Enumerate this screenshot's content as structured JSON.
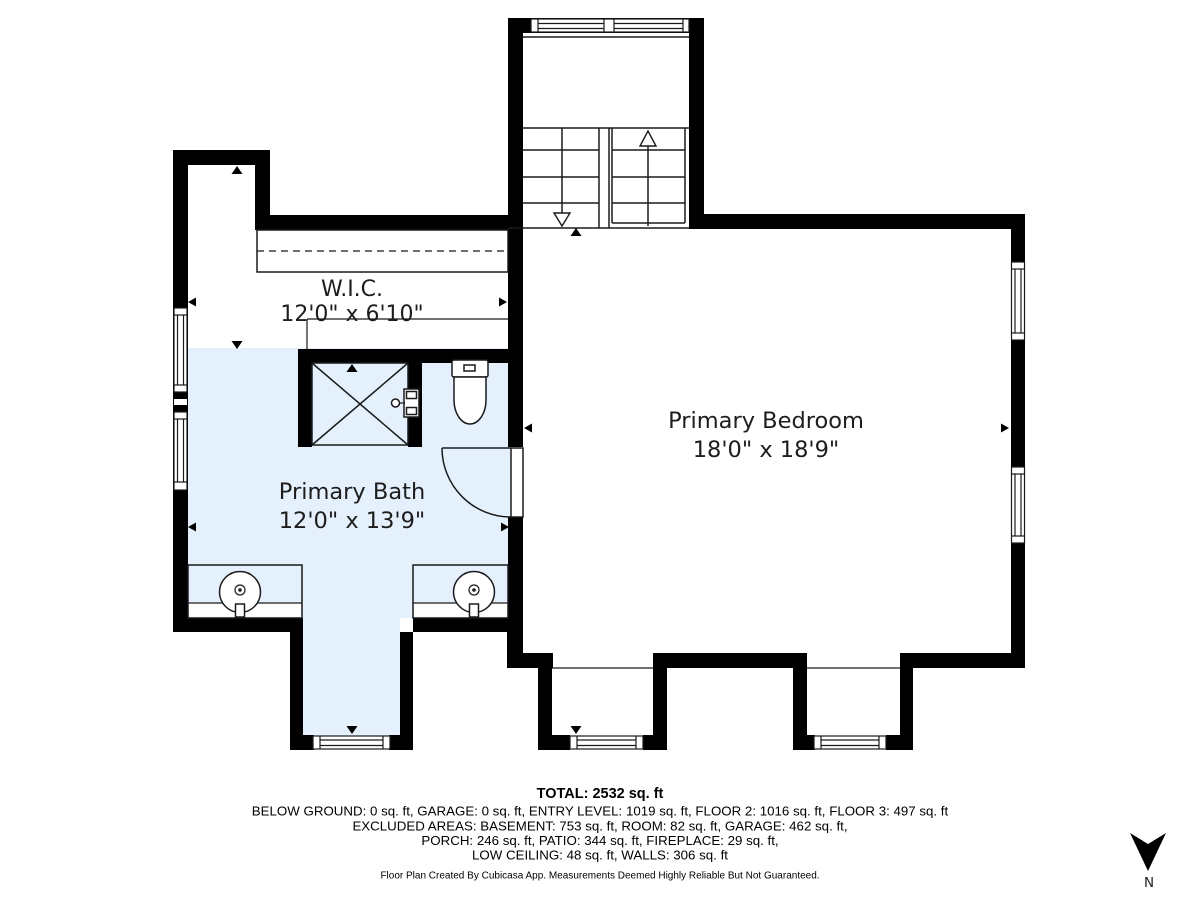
{
  "floorplan": {
    "rooms": [
      {
        "name": "W.I.C.",
        "dims": "12'0\" x 6'10\""
      },
      {
        "name": "Primary Bath",
        "dims": "12'0\" x 13'9\""
      },
      {
        "name": "Primary Bedroom",
        "dims": "18'0\" x 18'9\""
      }
    ],
    "compass_label": "N",
    "colors": {
      "wall": "#000000",
      "wet_area_floor": "#e4f0fc",
      "dry_area_floor": "#ffffff"
    }
  },
  "summary": {
    "total": "TOTAL: 2532 sq. ft",
    "line1": "BELOW GROUND: 0 sq. ft, GARAGE: 0 sq. ft, ENTRY LEVEL: 1019 sq. ft, FLOOR 2: 1016 sq. ft, FLOOR 3: 497 sq. ft",
    "line2": "EXCLUDED AREAS: BASEMENT: 753 sq. ft, ROOM: 82 sq. ft, GARAGE: 462 sq. ft,",
    "line3": "PORCH: 246 sq. ft, PATIO: 344 sq. ft, FIREPLACE: 29 sq. ft,",
    "line4": "LOW CEILING: 48 sq. ft, WALLS: 306 sq. ft",
    "disclaimer": "Floor Plan Created By Cubicasa App. Measurements Deemed Highly Reliable But Not Guaranteed."
  }
}
